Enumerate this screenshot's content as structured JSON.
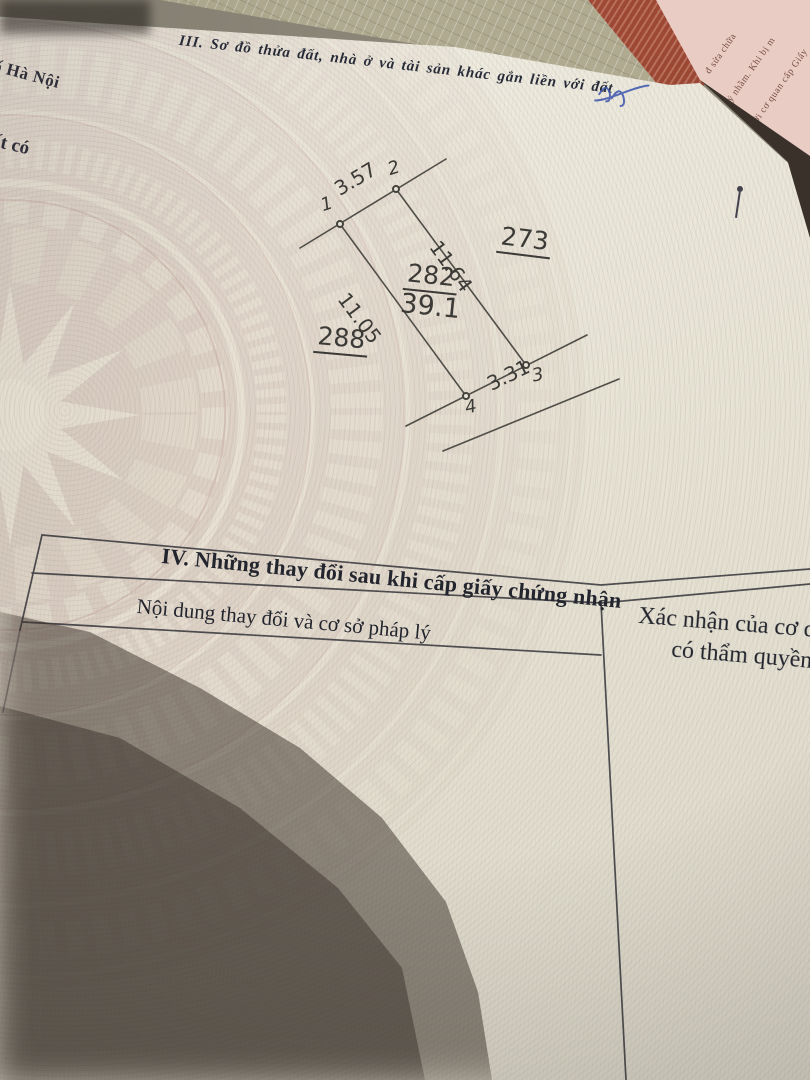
{
  "colors": {
    "paper": "#e9e5d8",
    "pattern_pink": "#cdb5ae",
    "cover_red": "#9c4634",
    "page_pink": "#e9ccc4",
    "ink": "#272b38",
    "pen_blue": "#3d55ad"
  },
  "header_fragments": {
    "line1": "ố Hà Nội",
    "line2": "ất có"
  },
  "section3": {
    "title": "III. Sơ đồ thửa đất, nhà ở và tài sản khác gắn liền với đất"
  },
  "diagram": {
    "parcel_number": "282",
    "area": "39.1",
    "neighbor_right": "273",
    "neighbor_left": "288",
    "v1": "1",
    "v2": "2",
    "v3": "3",
    "v4": "4",
    "len_1_2": "3.57",
    "len_2_3": "11.64",
    "len_1_4": "11.05",
    "len_4_3": "3.31"
  },
  "section4": {
    "title": "IV. Những thay đổi sau khi cấp giấy chứng nhận",
    "col1_header": "Nội dung thay đổi và cơ sở pháp lý",
    "col2_header_line1": "Xác nhận của cơ quan",
    "col2_header_line2": "có thẩm quyền"
  },
  "side_page": {
    "line1": "đ sửa chữa",
    "line2": "ý nhầm. Khi bị m",
    "line3": "o với cơ quan cấp Giấy"
  }
}
